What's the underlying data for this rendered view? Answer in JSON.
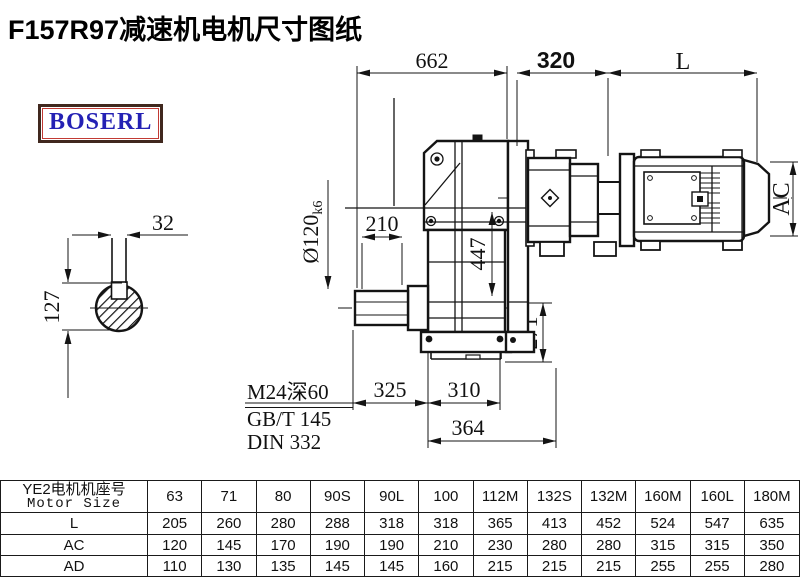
{
  "title": "F157R97减速机电机尺寸图纸",
  "brand": "BOSERL",
  "dims": {
    "overall_width": "662",
    "motor_flange_offset": "320",
    "motor_length": "L",
    "key_width": "32",
    "shaft_key_height": "127",
    "shoulder_length": "210",
    "shaft_diameter": "Ø120",
    "shaft_tolerance": "k6",
    "center_height": "447",
    "flange_height": "271",
    "shaft_extension": "325",
    "foot_width": "310",
    "base_width": "364",
    "motor_diameter": "AC"
  },
  "notes": {
    "tapped_hole": "M24深60",
    "standard_1": "GB/T 145",
    "standard_2": "DIN 332"
  },
  "table": {
    "header_cn": "YE2电机机座号",
    "header_en": "Motor Size",
    "columns": [
      "63",
      "71",
      "80",
      "90S",
      "90L",
      "100",
      "112M",
      "132S",
      "132M",
      "160M",
      "160L",
      "180M"
    ],
    "rows": [
      {
        "label": "L",
        "values": [
          "205",
          "260",
          "280",
          "288",
          "318",
          "318",
          "365",
          "413",
          "452",
          "524",
          "547",
          "635"
        ]
      },
      {
        "label": "AC",
        "values": [
          "120",
          "145",
          "170",
          "190",
          "190",
          "210",
          "230",
          "280",
          "280",
          "315",
          "315",
          "350"
        ]
      },
      {
        "label": "AD",
        "values": [
          "110",
          "130",
          "135",
          "145",
          "145",
          "160",
          "215",
          "215",
          "215",
          "255",
          "255",
          "280"
        ]
      }
    ]
  }
}
